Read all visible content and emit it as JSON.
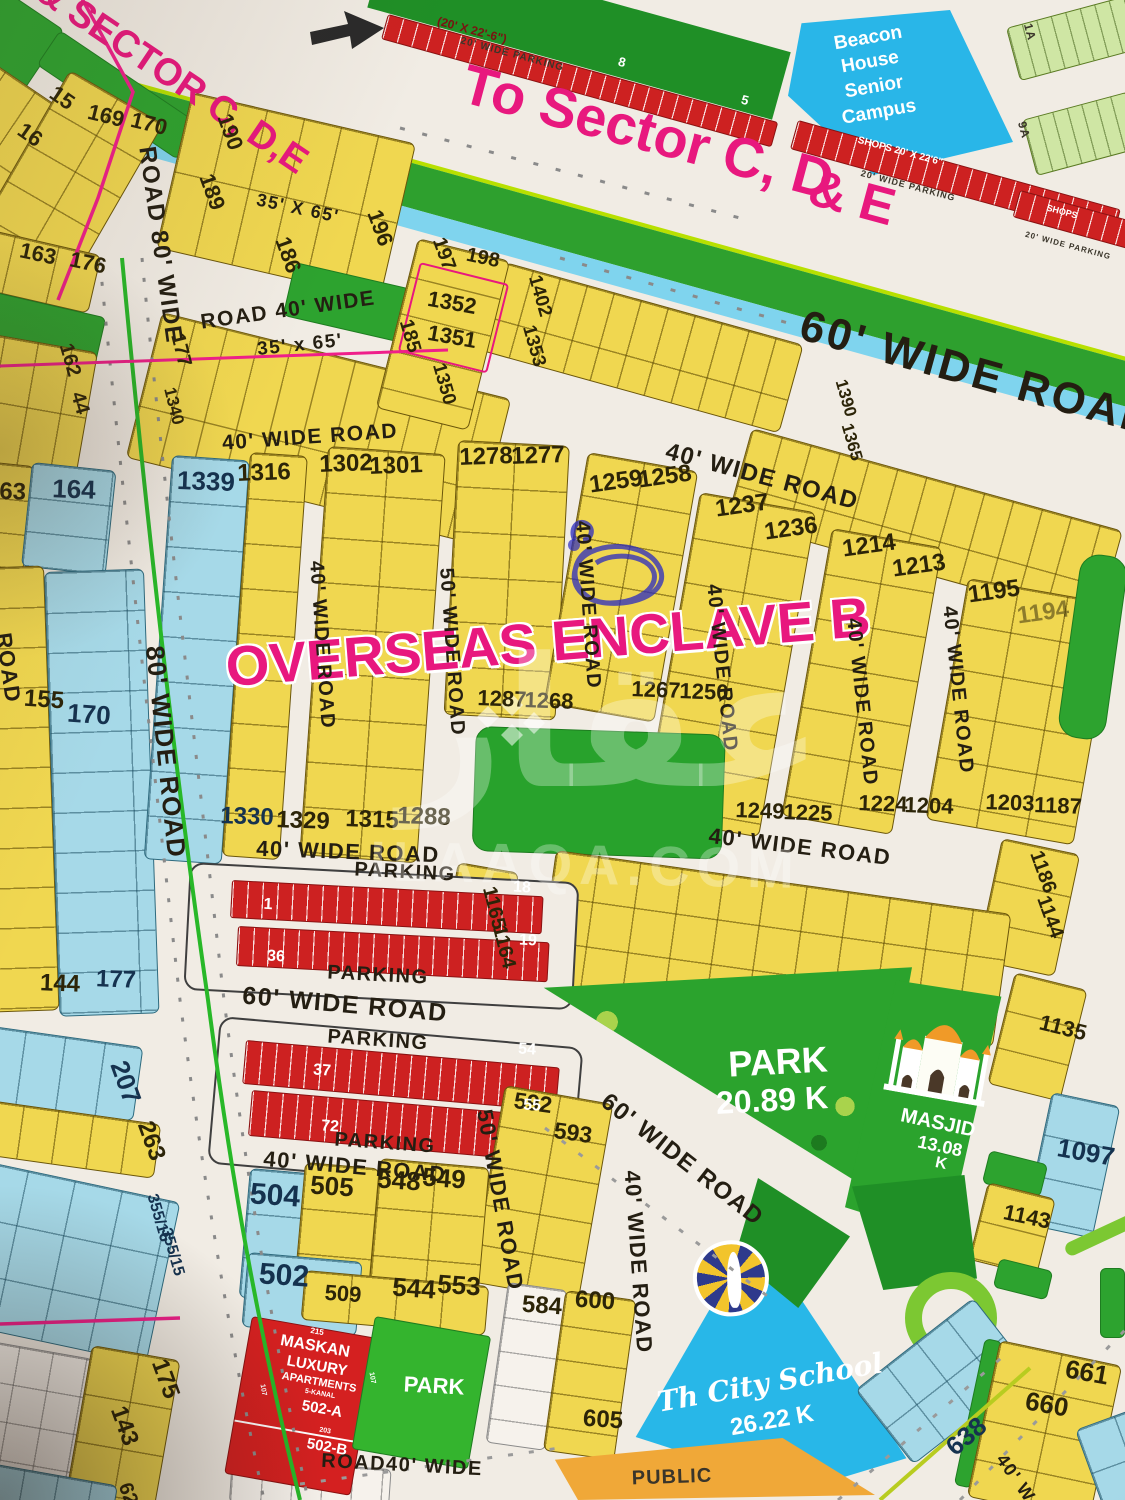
{
  "map_title": "OVERSEAS ENCLAVE B",
  "colors": {
    "plot_yellow": "#f0d750",
    "plot_blue": "#a6d9e8",
    "park_green": "#2da32f",
    "parking_red": "#cd2121",
    "school_cyan": "#28b7e8",
    "public_orange": "#f0a838",
    "accent_pink": "#e8187e",
    "road_bg": "#f1ece4",
    "roundabout_green": "#7cc832"
  },
  "watermark": {
    "logo_text": "عقار",
    "site": "ILAAQA.COM"
  },
  "labels": [
    {
      "t": "& SECTOR C, D,E",
      "x": 172,
      "y": 76,
      "r": 34,
      "s": 38,
      "c": "pink"
    },
    {
      "t": "To Sector C, D",
      "x": 648,
      "y": 132,
      "r": 15,
      "s": 56,
      "c": "pink"
    },
    {
      "t": "& E",
      "x": 852,
      "y": 198,
      "r": 15,
      "s": 52,
      "c": "pink"
    },
    {
      "t": "OVERSEAS ENCLAVE B",
      "x": 548,
      "y": 642,
      "r": -4.5,
      "s": 56,
      "c": "pink-o"
    },
    {
      "t": "ROAD 80' WIDE",
      "x": 160,
      "y": 245,
      "r": 82,
      "s": 24,
      "c": "road"
    },
    {
      "t": "80' WIDE ROAD",
      "x": 166,
      "y": 752,
      "r": 84,
      "s": 26,
      "c": "road"
    },
    {
      "t": "ROAD",
      "x": 8,
      "y": 668,
      "r": 82,
      "s": 22,
      "c": "road"
    },
    {
      "t": "ROAD 40' WIDE",
      "x": 288,
      "y": 310,
      "r": -8,
      "s": 21,
      "c": "road"
    },
    {
      "t": "35' x 65'",
      "x": 300,
      "y": 345,
      "r": -6,
      "s": 19,
      "c": "road"
    },
    {
      "t": "35' X 65'",
      "x": 298,
      "y": 208,
      "r": 12,
      "s": 18,
      "c": "road"
    },
    {
      "t": "40' WIDE ROAD",
      "x": 310,
      "y": 437,
      "r": -4,
      "s": 21,
      "c": "road"
    },
    {
      "t": "60' WIDE ROAD",
      "x": 978,
      "y": 374,
      "r": 15.5,
      "s": 44,
      "c": "road-lg"
    },
    {
      "t": "40' WIDE ROAD",
      "x": 762,
      "y": 477,
      "r": 15,
      "s": 24,
      "c": "road"
    },
    {
      "t": "40' WIDE ROAD",
      "x": 322,
      "y": 645,
      "r": 86,
      "s": 20,
      "c": "road"
    },
    {
      "t": "50' WIDE ROAD",
      "x": 452,
      "y": 652,
      "r": 86,
      "s": 20,
      "c": "road"
    },
    {
      "t": "40' WIDE ROAD",
      "x": 588,
      "y": 605,
      "r": 86,
      "s": 20,
      "c": "road"
    },
    {
      "t": "40' WIDE ROAD",
      "x": 722,
      "y": 668,
      "r": 84,
      "s": 20,
      "c": "road"
    },
    {
      "t": "40' WIDE ROAD",
      "x": 862,
      "y": 702,
      "r": 84,
      "s": 20,
      "c": "road"
    },
    {
      "t": "40' WIDE ROAD",
      "x": 958,
      "y": 690,
      "r": 84,
      "s": 20,
      "c": "road"
    },
    {
      "t": "40' WIDE ROAD",
      "x": 348,
      "y": 852,
      "r": 2,
      "s": 22,
      "c": "road"
    },
    {
      "t": "40' WIDE ROAD",
      "x": 800,
      "y": 847,
      "r": 7,
      "s": 22,
      "c": "road"
    },
    {
      "t": "60' WIDE ROAD",
      "x": 345,
      "y": 1005,
      "r": 5,
      "s": 25,
      "c": "road"
    },
    {
      "t": "40' WIDE ROAD",
      "x": 355,
      "y": 1167,
      "r": 5,
      "s": 22,
      "c": "road"
    },
    {
      "t": "60' WIDE ROAD",
      "x": 682,
      "y": 1160,
      "r": 38,
      "s": 24,
      "c": "road"
    },
    {
      "t": "50' WIDE ROAD",
      "x": 500,
      "y": 1200,
      "r": 80,
      "s": 22,
      "c": "road"
    },
    {
      "t": "40' WIDE ROAD",
      "x": 638,
      "y": 1262,
      "r": 86,
      "s": 22,
      "c": "road"
    },
    {
      "t": "ROAD40' WIDE",
      "x": 402,
      "y": 1465,
      "r": 3,
      "s": 20,
      "c": "road"
    },
    {
      "t": "40' W",
      "x": 1016,
      "y": 1478,
      "r": 55,
      "s": 18,
      "c": "road"
    },
    {
      "t": "PARKING",
      "x": 405,
      "y": 872,
      "r": 3,
      "s": 20,
      "c": "road"
    },
    {
      "t": "PARKING",
      "x": 378,
      "y": 975,
      "r": 3,
      "s": 20,
      "c": "road"
    },
    {
      "t": "PARKING",
      "x": 378,
      "y": 1040,
      "r": 4,
      "s": 20,
      "c": "road"
    },
    {
      "t": "PARKING",
      "x": 385,
      "y": 1143,
      "r": 4,
      "s": 20,
      "c": "road"
    },
    {
      "t": "(20' X 22'-6\")",
      "x": 472,
      "y": 30,
      "r": 15,
      "s": 12,
      "c": "dkred"
    },
    {
      "t": "20' WIDE PARKING",
      "x": 512,
      "y": 55,
      "r": 15,
      "s": 10,
      "c": "dark"
    },
    {
      "t": "SHOPS 20' X 22'6\"",
      "x": 900,
      "y": 152,
      "r": 15,
      "s": 10,
      "c": "white"
    },
    {
      "t": "20' WIDE PARKING",
      "x": 908,
      "y": 186,
      "r": 15,
      "s": 9,
      "c": "dark"
    },
    {
      "t": "SHOPS",
      "x": 1062,
      "y": 212,
      "r": 15,
      "s": 9,
      "c": "white"
    },
    {
      "t": "20' WIDE PARKING",
      "x": 1068,
      "y": 246,
      "r": 15,
      "s": 8,
      "c": "dark"
    },
    {
      "t": "8",
      "x": 622,
      "y": 62,
      "r": 15,
      "s": 13,
      "c": "white"
    },
    {
      "t": "5",
      "x": 745,
      "y": 100,
      "r": 15,
      "s": 13,
      "c": "white"
    },
    {
      "t": "1A",
      "x": 1030,
      "y": 32,
      "r": 75,
      "s": 12,
      "c": "dark"
    },
    {
      "t": "9A",
      "x": 1024,
      "y": 130,
      "r": 75,
      "s": 12,
      "c": "dark"
    },
    {
      "t": "15",
      "x": 62,
      "y": 98,
      "r": 35,
      "s": 22,
      "c": "plot"
    },
    {
      "t": "16",
      "x": 30,
      "y": 135,
      "r": 35,
      "s": 22,
      "c": "plot"
    },
    {
      "t": "169",
      "x": 106,
      "y": 116,
      "r": 14,
      "s": 22,
      "c": "plot"
    },
    {
      "t": "170",
      "x": 149,
      "y": 124,
      "r": 14,
      "s": 22,
      "c": "plot"
    },
    {
      "t": "189",
      "x": 212,
      "y": 192,
      "r": 70,
      "s": 22,
      "c": "plot"
    },
    {
      "t": "190",
      "x": 230,
      "y": 132,
      "r": 70,
      "s": 22,
      "c": "plot"
    },
    {
      "t": "186",
      "x": 288,
      "y": 255,
      "r": 70,
      "s": 22,
      "c": "plot"
    },
    {
      "t": "196",
      "x": 380,
      "y": 228,
      "r": 70,
      "s": 22,
      "c": "plot"
    },
    {
      "t": "163",
      "x": 38,
      "y": 254,
      "r": 12,
      "s": 22,
      "c": "plot"
    },
    {
      "t": "176",
      "x": 88,
      "y": 263,
      "r": 12,
      "s": 22,
      "c": "plot"
    },
    {
      "t": "162",
      "x": 70,
      "y": 360,
      "r": 74,
      "s": 20,
      "c": "plot"
    },
    {
      "t": "44",
      "x": 80,
      "y": 403,
      "r": 74,
      "s": 20,
      "c": "plot"
    },
    {
      "t": "177",
      "x": 181,
      "y": 350,
      "r": 76,
      "s": 20,
      "c": "plot"
    },
    {
      "t": "1340",
      "x": 174,
      "y": 406,
      "r": 76,
      "s": 17,
      "c": "plot"
    },
    {
      "t": "197",
      "x": 444,
      "y": 254,
      "r": 70,
      "s": 20,
      "c": "plot"
    },
    {
      "t": "198",
      "x": 483,
      "y": 258,
      "r": 12,
      "s": 20,
      "c": "plot"
    },
    {
      "t": "1352",
      "x": 452,
      "y": 303,
      "r": 10,
      "s": 22,
      "c": "plot"
    },
    {
      "t": "1351",
      "x": 452,
      "y": 337,
      "r": 10,
      "s": 22,
      "c": "plot"
    },
    {
      "t": "185",
      "x": 410,
      "y": 336,
      "r": 74,
      "s": 20,
      "c": "plot"
    },
    {
      "t": "1350",
      "x": 444,
      "y": 384,
      "r": 74,
      "s": 19,
      "c": "plot"
    },
    {
      "t": "1402",
      "x": 540,
      "y": 296,
      "r": 74,
      "s": 19,
      "c": "plot"
    },
    {
      "t": "1353",
      "x": 534,
      "y": 346,
      "r": 74,
      "s": 19,
      "c": "plot"
    },
    {
      "t": "1390",
      "x": 846,
      "y": 398,
      "r": 74,
      "s": 17,
      "c": "plot"
    },
    {
      "t": "1365",
      "x": 852,
      "y": 442,
      "r": 74,
      "s": 17,
      "c": "plot"
    },
    {
      "t": "1339",
      "x": 206,
      "y": 481,
      "r": 2,
      "s": 26,
      "c": "navy"
    },
    {
      "t": "1316",
      "x": 264,
      "y": 473,
      "r": -2,
      "s": 24,
      "c": "plot"
    },
    {
      "t": "1302",
      "x": 346,
      "y": 464,
      "r": -2,
      "s": 24,
      "c": "plot"
    },
    {
      "t": "1301",
      "x": 396,
      "y": 466,
      "r": -2,
      "s": 24,
      "c": "plot"
    },
    {
      "t": "1278",
      "x": 486,
      "y": 457,
      "r": -2,
      "s": 24,
      "c": "plot"
    },
    {
      "t": "1277",
      "x": 538,
      "y": 456,
      "r": -2,
      "s": 24,
      "c": "plot"
    },
    {
      "t": "1259",
      "x": 616,
      "y": 482,
      "r": -8,
      "s": 24,
      "c": "plot"
    },
    {
      "t": "1258",
      "x": 665,
      "y": 477,
      "r": -8,
      "s": 24,
      "c": "plot"
    },
    {
      "t": "1237",
      "x": 742,
      "y": 506,
      "r": -8,
      "s": 24,
      "c": "plot"
    },
    {
      "t": "1236",
      "x": 791,
      "y": 529,
      "r": -8,
      "s": 24,
      "c": "plot"
    },
    {
      "t": "1214",
      "x": 869,
      "y": 546,
      "r": -8,
      "s": 24,
      "c": "plot"
    },
    {
      "t": "1213",
      "x": 919,
      "y": 566,
      "r": -8,
      "s": 24,
      "c": "plot"
    },
    {
      "t": "1195",
      "x": 994,
      "y": 592,
      "r": -8,
      "s": 24,
      "c": "plot"
    },
    {
      "t": "1194",
      "x": 1043,
      "y": 613,
      "r": -8,
      "s": 24,
      "c": "faded"
    },
    {
      "t": "164",
      "x": 74,
      "y": 489,
      "r": 2,
      "s": 26,
      "c": "navy"
    },
    {
      "t": "163",
      "x": 6,
      "y": 492,
      "r": 2,
      "s": 24,
      "c": "plot"
    },
    {
      "t": "155",
      "x": 44,
      "y": 700,
      "r": 4,
      "s": 24,
      "c": "plot"
    },
    {
      "t": "170",
      "x": 89,
      "y": 714,
      "r": 4,
      "s": 26,
      "c": "navy"
    },
    {
      "t": "144",
      "x": 60,
      "y": 984,
      "r": 2,
      "s": 24,
      "c": "plot"
    },
    {
      "t": "177",
      "x": 116,
      "y": 980,
      "r": 2,
      "s": 24,
      "c": "navy"
    },
    {
      "t": "207",
      "x": 126,
      "y": 1082,
      "r": 70,
      "s": 26,
      "c": "navy"
    },
    {
      "t": "263",
      "x": 151,
      "y": 1141,
      "r": 70,
      "s": 24,
      "c": "plot"
    },
    {
      "t": "355/16",
      "x": 158,
      "y": 1218,
      "r": 74,
      "s": 16,
      "c": "navy"
    },
    {
      "t": "355/15",
      "x": 172,
      "y": 1252,
      "r": 74,
      "s": 16,
      "c": "navy"
    },
    {
      "t": "1330",
      "x": 247,
      "y": 817,
      "r": 2,
      "s": 24,
      "c": "navy"
    },
    {
      "t": "1329",
      "x": 303,
      "y": 821,
      "r": 2,
      "s": 24,
      "c": "plot"
    },
    {
      "t": "1315",
      "x": 372,
      "y": 820,
      "r": 2,
      "s": 24,
      "c": "plot"
    },
    {
      "t": "1288",
      "x": 424,
      "y": 817,
      "r": 2,
      "s": 24,
      "c": "plot"
    },
    {
      "t": "1287",
      "x": 502,
      "y": 699,
      "r": 2,
      "s": 22,
      "c": "plot"
    },
    {
      "t": "1268",
      "x": 549,
      "y": 701,
      "r": 2,
      "s": 22,
      "c": "plot"
    },
    {
      "t": "1267",
      "x": 656,
      "y": 690,
      "r": 2,
      "s": 22,
      "c": "plot"
    },
    {
      "t": "1250",
      "x": 704,
      "y": 692,
      "r": 2,
      "s": 22,
      "c": "plot"
    },
    {
      "t": "1249",
      "x": 760,
      "y": 811,
      "r": 2,
      "s": 22,
      "c": "plot"
    },
    {
      "t": "1225",
      "x": 808,
      "y": 813,
      "r": 2,
      "s": 22,
      "c": "plot"
    },
    {
      "t": "1224",
      "x": 883,
      "y": 804,
      "r": 2,
      "s": 22,
      "c": "plot"
    },
    {
      "t": "1204",
      "x": 929,
      "y": 806,
      "r": 2,
      "s": 22,
      "c": "plot"
    },
    {
      "t": "1203",
      "x": 1010,
      "y": 803,
      "r": 2,
      "s": 22,
      "c": "plot"
    },
    {
      "t": "1187",
      "x": 1058,
      "y": 806,
      "r": 2,
      "s": 22,
      "c": "plot"
    },
    {
      "t": "1165",
      "x": 494,
      "y": 908,
      "r": 76,
      "s": 20,
      "c": "plot"
    },
    {
      "t": "1164",
      "x": 504,
      "y": 947,
      "r": 76,
      "s": 20,
      "c": "plot"
    },
    {
      "t": "1186",
      "x": 1043,
      "y": 872,
      "r": 70,
      "s": 20,
      "c": "plot"
    },
    {
      "t": "1144",
      "x": 1050,
      "y": 917,
      "r": 70,
      "s": 20,
      "c": "plot"
    },
    {
      "t": "1135",
      "x": 1063,
      "y": 1028,
      "r": 14,
      "s": 22,
      "c": "plot"
    },
    {
      "t": "1097",
      "x": 1086,
      "y": 1152,
      "r": 10,
      "s": 26,
      "c": "navy"
    },
    {
      "t": "1143",
      "x": 1027,
      "y": 1217,
      "r": 12,
      "s": 22,
      "c": "plot"
    },
    {
      "t": "592",
      "x": 533,
      "y": 1103,
      "r": 8,
      "s": 23,
      "c": "plot"
    },
    {
      "t": "593",
      "x": 573,
      "y": 1133,
      "r": 8,
      "s": 23,
      "c": "plot"
    },
    {
      "t": "504",
      "x": 275,
      "y": 1196,
      "r": 4,
      "s": 30,
      "c": "navy"
    },
    {
      "t": "505",
      "x": 332,
      "y": 1186,
      "r": 4,
      "s": 26,
      "c": "plot"
    },
    {
      "t": "548",
      "x": 399,
      "y": 1180,
      "r": 4,
      "s": 26,
      "c": "plot"
    },
    {
      "t": "549",
      "x": 444,
      "y": 1178,
      "r": 4,
      "s": 26,
      "c": "plot"
    },
    {
      "t": "502",
      "x": 284,
      "y": 1276,
      "r": 4,
      "s": 30,
      "c": "navy"
    },
    {
      "t": "509",
      "x": 343,
      "y": 1294,
      "r": 4,
      "s": 22,
      "c": "plot"
    },
    {
      "t": "544",
      "x": 414,
      "y": 1288,
      "r": 4,
      "s": 26,
      "c": "plot"
    },
    {
      "t": "553",
      "x": 459,
      "y": 1285,
      "r": 4,
      "s": 26,
      "c": "plot"
    },
    {
      "t": "584",
      "x": 542,
      "y": 1306,
      "r": 4,
      "s": 24,
      "c": "plot"
    },
    {
      "t": "600",
      "x": 595,
      "y": 1301,
      "r": 4,
      "s": 24,
      "c": "plot"
    },
    {
      "t": "605",
      "x": 603,
      "y": 1420,
      "r": 4,
      "s": 24,
      "c": "plot"
    },
    {
      "t": "638",
      "x": 966,
      "y": 1436,
      "r": -40,
      "s": 26,
      "c": "navy"
    },
    {
      "t": "661",
      "x": 1087,
      "y": 1372,
      "r": 10,
      "s": 26,
      "c": "plot"
    },
    {
      "t": "660",
      "x": 1047,
      "y": 1404,
      "r": 10,
      "s": 26,
      "c": "plot"
    },
    {
      "t": "175",
      "x": 165,
      "y": 1379,
      "r": 70,
      "s": 24,
      "c": "plot"
    },
    {
      "t": "143",
      "x": 124,
      "y": 1426,
      "r": 70,
      "s": 24,
      "c": "plot"
    },
    {
      "t": "62",
      "x": 128,
      "y": 1494,
      "r": 70,
      "s": 20,
      "c": "plot"
    },
    {
      "t": "Beacon",
      "x": 868,
      "y": 38,
      "r": -10,
      "s": 19,
      "c": "white"
    },
    {
      "t": "House",
      "x": 870,
      "y": 62,
      "r": -10,
      "s": 19,
      "c": "white"
    },
    {
      "t": "Senior",
      "x": 874,
      "y": 87,
      "r": -10,
      "s": 19,
      "c": "white"
    },
    {
      "t": "Campus",
      "x": 879,
      "y": 112,
      "r": -10,
      "s": 19,
      "c": "white"
    },
    {
      "t": "PARK",
      "x": 778,
      "y": 1062,
      "r": -3,
      "s": 36,
      "c": "white"
    },
    {
      "t": "20.89 K",
      "x": 772,
      "y": 1100,
      "r": -3,
      "s": 32,
      "c": "white"
    },
    {
      "t": "MASJID",
      "x": 938,
      "y": 1123,
      "r": 12,
      "s": 20,
      "c": "white"
    },
    {
      "t": "13.08",
      "x": 940,
      "y": 1146,
      "r": 12,
      "s": 18,
      "c": "white"
    },
    {
      "t": "K",
      "x": 941,
      "y": 1164,
      "r": 12,
      "s": 16,
      "c": "white"
    },
    {
      "t": "Th City School",
      "x": 770,
      "y": 1383,
      "r": -10,
      "s": 28,
      "c": "script"
    },
    {
      "t": "26.22 K",
      "x": 772,
      "y": 1421,
      "r": -10,
      "s": 24,
      "c": "white"
    },
    {
      "t": "PARK",
      "x": 434,
      "y": 1386,
      "r": 3,
      "s": 22,
      "c": "white"
    },
    {
      "t": "PUBLIC",
      "x": 672,
      "y": 1477,
      "r": -2,
      "s": 20,
      "c": "dark"
    },
    {
      "t": "215",
      "x": 317,
      "y": 1332,
      "r": 10,
      "s": 8,
      "c": "white"
    },
    {
      "t": "MASKAN",
      "x": 315,
      "y": 1347,
      "r": 10,
      "s": 16,
      "c": "white"
    },
    {
      "t": "LUXURY",
      "x": 317,
      "y": 1366,
      "r": 10,
      "s": 15,
      "c": "white"
    },
    {
      "t": "APARTMENTS",
      "x": 319,
      "y": 1383,
      "r": 10,
      "s": 11,
      "c": "white"
    },
    {
      "t": "5-KANAL",
      "x": 320,
      "y": 1394,
      "r": 10,
      "s": 7,
      "c": "white"
    },
    {
      "t": "502-A",
      "x": 322,
      "y": 1409,
      "r": 10,
      "s": 15,
      "c": "white"
    },
    {
      "t": "107",
      "x": 263,
      "y": 1390,
      "r": 80,
      "s": 7,
      "c": "white"
    },
    {
      "t": "107",
      "x": 372,
      "y": 1378,
      "r": 80,
      "s": 7,
      "c": "white"
    },
    {
      "t": "203",
      "x": 325,
      "y": 1431,
      "r": 10,
      "s": 7,
      "c": "white"
    },
    {
      "t": "502-B",
      "x": 327,
      "y": 1447,
      "r": 10,
      "s": 15,
      "c": "white"
    },
    {
      "t": "1",
      "x": 268,
      "y": 905,
      "r": 3,
      "s": 16,
      "c": "white"
    },
    {
      "t": "18",
      "x": 522,
      "y": 888,
      "r": 3,
      "s": 16,
      "c": "white"
    },
    {
      "t": "36",
      "x": 276,
      "y": 957,
      "r": 3,
      "s": 16,
      "c": "white"
    },
    {
      "t": "19",
      "x": 528,
      "y": 941,
      "r": 3,
      "s": 16,
      "c": "white"
    },
    {
      "t": "37",
      "x": 322,
      "y": 1071,
      "r": 4,
      "s": 16,
      "c": "white"
    },
    {
      "t": "54",
      "x": 527,
      "y": 1050,
      "r": 4,
      "s": 16,
      "c": "white"
    },
    {
      "t": "72",
      "x": 330,
      "y": 1127,
      "r": 4,
      "s": 16,
      "c": "white"
    },
    {
      "t": "55",
      "x": 532,
      "y": 1106,
      "r": 4,
      "s": 16,
      "c": "white"
    }
  ]
}
